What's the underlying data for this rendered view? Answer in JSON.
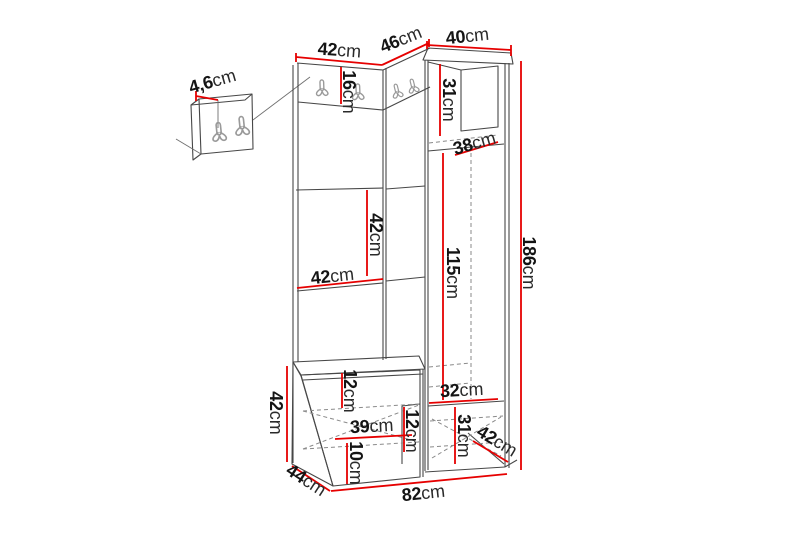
{
  "diagram": {
    "type": "furniture-dimension-diagram",
    "unit": "cm",
    "colors": {
      "dimension_line": "#e60000",
      "outline": "#474747",
      "hidden_line": "#8a8a8a",
      "label_text": "#141414",
      "hook": "#9a9a9a",
      "background": "#ffffff"
    },
    "measurements": {
      "panel_thickness": {
        "num": "4,6",
        "unit": "cm"
      },
      "top_width_left": {
        "num": "42",
        "unit": "cm"
      },
      "top_width_corner": {
        "num": "46",
        "unit": "cm"
      },
      "top_width_right": {
        "num": "40",
        "unit": "cm"
      },
      "hook_strip_height": {
        "num": "16",
        "unit": "cm"
      },
      "upper_compartment_height": {
        "num": "31",
        "unit": "cm"
      },
      "upper_compartment_depth": {
        "num": "38",
        "unit": "cm"
      },
      "mid_section_height": {
        "num": "42",
        "unit": "cm"
      },
      "mid_shelf_width": {
        "num": "42",
        "unit": "cm"
      },
      "door_height": {
        "num": "115",
        "unit": "cm"
      },
      "total_height": {
        "num": "186",
        "unit": "cm"
      },
      "lower_shelf_width": {
        "num": "32",
        "unit": "cm"
      },
      "side_gap_height": {
        "num": "12",
        "unit": "cm"
      },
      "lower_compartment_height": {
        "num": "31",
        "unit": "cm"
      },
      "cabinet_depth": {
        "num": "42",
        "unit": "cm"
      },
      "bench_height": {
        "num": "42",
        "unit": "cm"
      },
      "bench_top_height": {
        "num": "12",
        "unit": "cm"
      },
      "bench_inner_width": {
        "num": "39",
        "unit": "cm"
      },
      "bench_bottom_height": {
        "num": "10",
        "unit": "cm"
      },
      "bench_depth": {
        "num": "44",
        "unit": "cm"
      },
      "base_width": {
        "num": "82",
        "unit": "cm"
      }
    }
  }
}
